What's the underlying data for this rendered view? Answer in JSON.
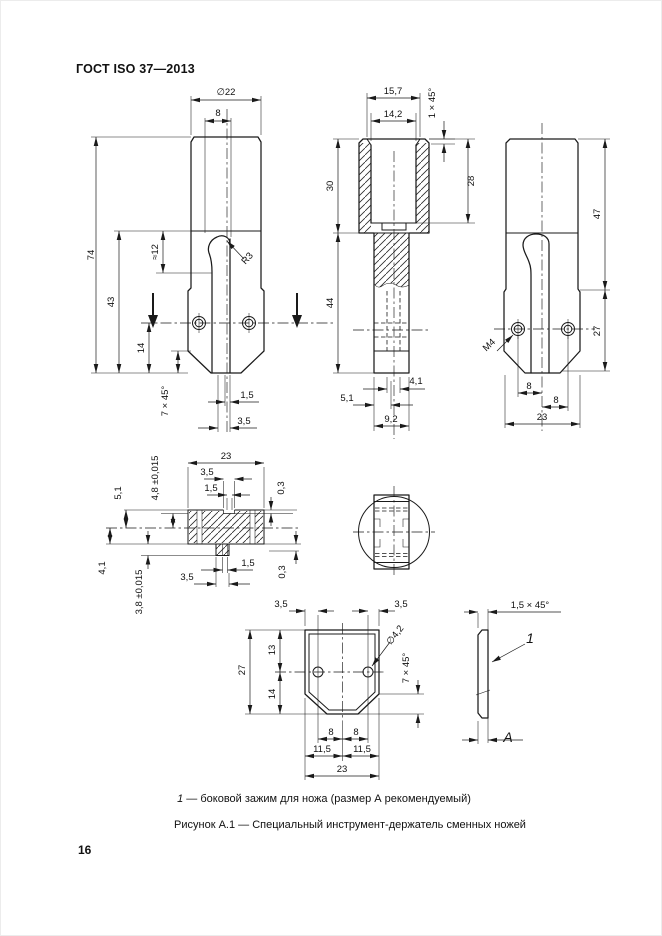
{
  "page": {
    "header": "ГОСТ ISO 37—2013",
    "number": "16"
  },
  "caption": {
    "legend_ref": "1",
    "legend_text": " — боковой зажим для ножа (размер А рекомендуемый)",
    "figure": "Рисунок А.1 — Специальный инструмент-держатель сменных ножей"
  },
  "front_view": {
    "dia": "∅22",
    "slot_width_top": "8",
    "total_height": "74",
    "lower_height": "43",
    "hook_depth": "≈12",
    "hook_radius": "R3",
    "hole_to_bottom": "14",
    "bottom_chamfer": "7 × 45°",
    "slot_gap": "1,5",
    "tongue_offset": "3,5"
  },
  "section_view": {
    "outer_top": "15,7",
    "bore": "14,2",
    "top_chamfer": "1 × 45°",
    "bore_depth": "28",
    "head_height": "30",
    "stem_height": "44",
    "hole_dia": "4,1",
    "hole_offset": "5,1",
    "stem_width": "9,2"
  },
  "side_view": {
    "upper_height": "47",
    "lower_height": "27",
    "thread": "M4",
    "hole_left": "8",
    "hole_right": "8",
    "width": "23"
  },
  "plan_section_view": {
    "width": "23",
    "notch_top": "3,5",
    "slot_top": "1,5",
    "notch_depth_top": "0,3",
    "plate_upper": "5,1",
    "plate_upper_tol": "4,8 ±0,015",
    "plate_lower": "4,1",
    "plate_lower_tol": "3,8 ±0,015",
    "tab_bottom": "3,5",
    "slot_bottom": "1,5",
    "notch_depth_bottom": "0,3"
  },
  "clamp_view": {
    "edge_left": "3,5",
    "edge_right": "3,5",
    "height": "27",
    "hole_top": "13",
    "hole_bottom": "14",
    "hole_dia": "∅4,2",
    "chamfer": "7 × 45°",
    "hole_left": "8",
    "hole_right": "8",
    "spacing_left": "11,5",
    "spacing_right": "11,5",
    "width": "23"
  },
  "plate_view": {
    "chamfer": "1,5 × 45°",
    "ref": "1",
    "thickness": "A"
  }
}
